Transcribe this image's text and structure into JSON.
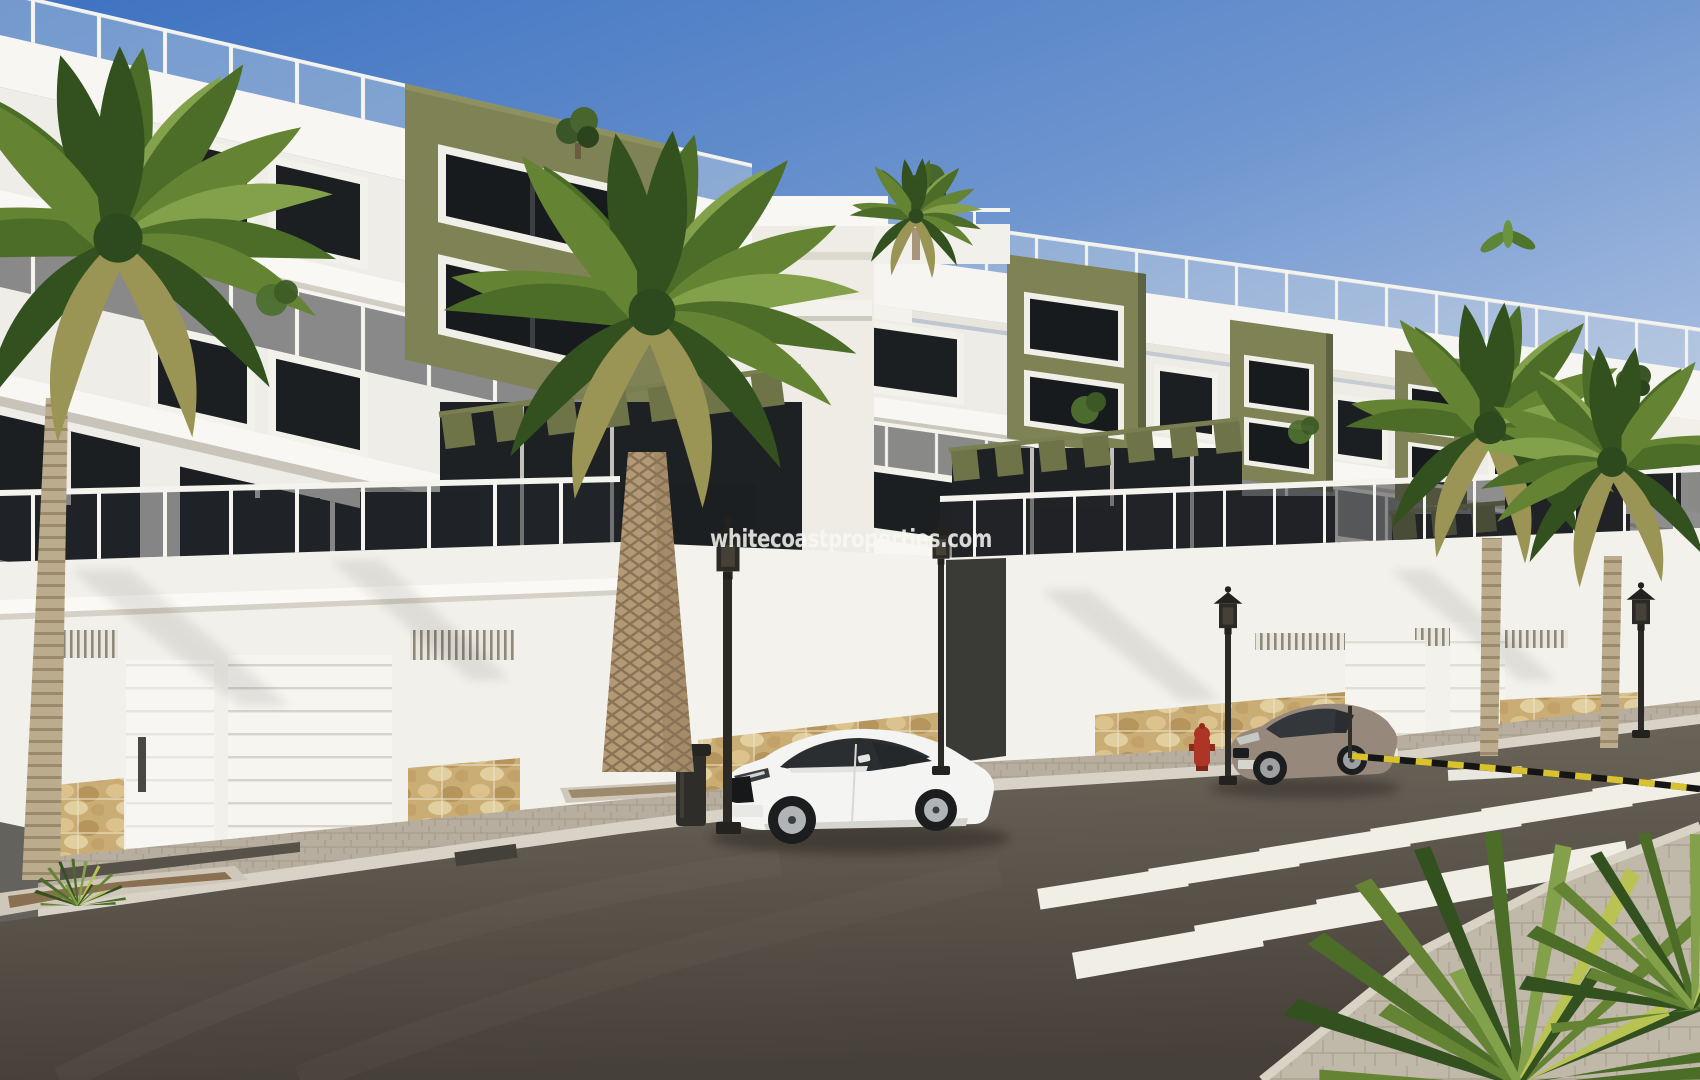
{
  "image": {
    "kind": "architectural-render-photo",
    "width": 1700,
    "height": 1080
  },
  "watermark": {
    "text": "whitecoastproperties.com",
    "color": "#f8f8f5",
    "opacity": 0.85
  },
  "palette": {
    "sky_top": "#3d72c1",
    "sky_horizon": "#e7edf6",
    "facade_white": "#f3f1ec",
    "facade_shade": "#dedbd2",
    "accent_olive": "#7e8254",
    "accent_olive_dark": "#5d6340",
    "window_glass": "#1c1f22",
    "balcony_beige": "#d9d1c3",
    "stone_base": "#c9ad74",
    "sidewalk": "#bcb4a5",
    "road_asphalt": "#57504c",
    "crosswalk_white": "#f2f0e8",
    "caution_yellow": "#d8c32f",
    "caution_black": "#151513",
    "car_white": "#f4f4f2",
    "car_taupe": "#96887b",
    "lamp_iron": "#2b2a26",
    "hydrant_red": "#ae3526",
    "palm_green": "#4b6d28",
    "palm_trunk": "#b29a76"
  },
  "scene": {
    "buildings": [
      {
        "name": "left-apartment-block",
        "stories": 3,
        "accent": "olive-green",
        "features": "glass balconies, roof terrace railing"
      },
      {
        "name": "right-apartment-block",
        "stories": 3,
        "accent": "olive-green",
        "features": "glass balconies, cornice mouldings, pergolas"
      }
    ],
    "street": {
      "street_lamps": 4,
      "trash_bin": 1,
      "fire_hydrant": 1,
      "caution_tape": true,
      "crosswalk_stripes": 10,
      "garage_doors": 4,
      "ventilation_grilles": 5
    },
    "vehicles": [
      {
        "name": "white-coupe",
        "color": "white"
      },
      {
        "name": "beige-coupe",
        "color": "beige"
      }
    ],
    "vegetation": {
      "street_palm_trees": 5,
      "rooftop_plants": 4,
      "foreground_shrubs": 3,
      "balcony_plants": 3
    }
  }
}
